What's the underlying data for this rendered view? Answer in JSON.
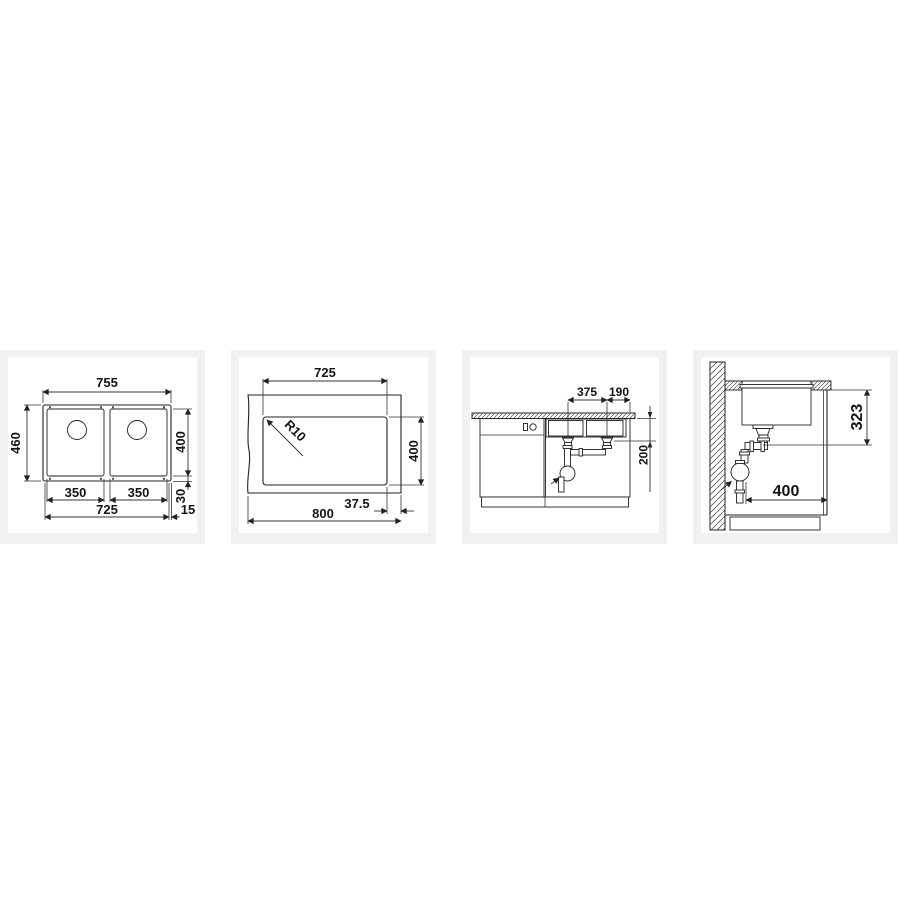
{
  "colors": {
    "page_bg": "#ffffff",
    "card_bg": "#f1f1f2",
    "line": "#222222",
    "text": "#141414"
  },
  "panels": [
    {
      "title": "top-view-double-bowl",
      "labels": {
        "overall_width": "755",
        "overall_depth": "460",
        "bowl_depth": "400",
        "bowl_width_left": "350",
        "bowl_width_right": "350",
        "cutout_width": "725",
        "rear_edge": "30",
        "side_edge": "15"
      }
    },
    {
      "title": "worktop-cutout-plan",
      "labels": {
        "cutout_width": "725",
        "corner_radius": "R10",
        "cutout_depth": "400",
        "side_offset": "37.5",
        "worktop_width": "800"
      }
    },
    {
      "title": "installation-front-view",
      "labels": {
        "drain_spacing": "375",
        "drain_to_edge": "190",
        "outlet_drop": "200"
      }
    },
    {
      "title": "installation-side-view",
      "labels": {
        "outlet_depth": "323",
        "cabinet_depth": "400"
      }
    }
  ]
}
